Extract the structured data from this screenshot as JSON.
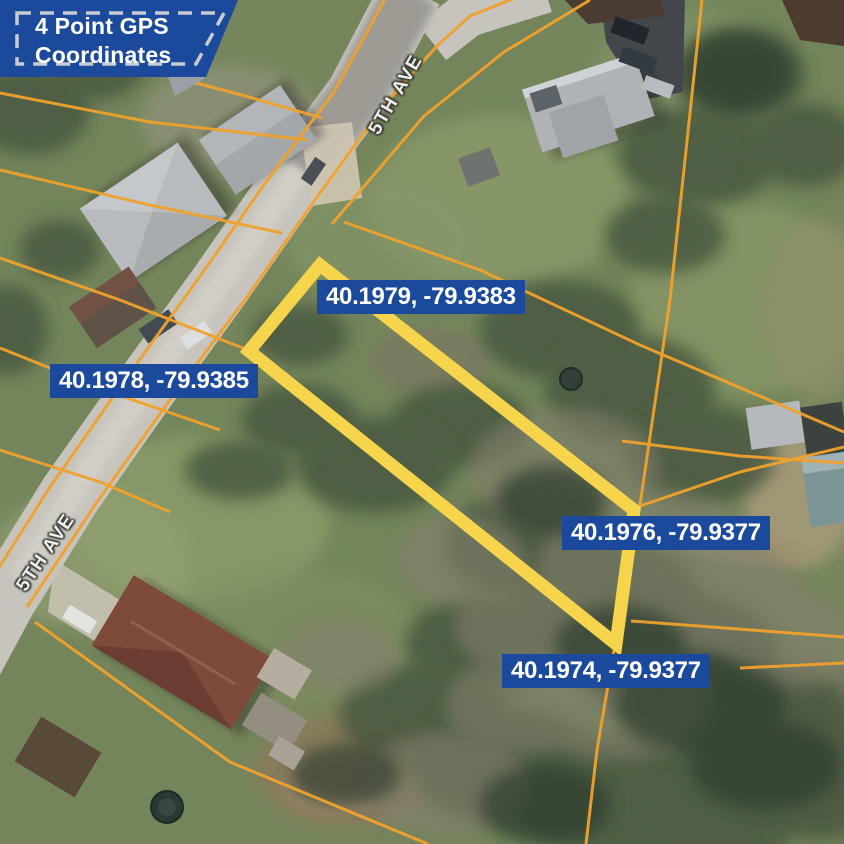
{
  "badge": {
    "line1": "4 Point GPS",
    "line2": "Coordinates"
  },
  "markers": [
    {
      "label": "40.1979, -79.9383"
    },
    {
      "label": "40.1978, -79.9385"
    },
    {
      "label": "40.1976, -79.9377"
    },
    {
      "label": "40.1974, -79.9377"
    }
  ],
  "streets": [
    {
      "name": "5TH AVE"
    },
    {
      "name": "5TH AVE"
    }
  ],
  "colors": {
    "label_bg": "#1b4a9c",
    "badge_bg": "#1b4a9c",
    "badge_dash": "#c7ccd2",
    "boundary_yellow": "#f6d44c",
    "parcel_line_orange": "#f0a22d",
    "pin_red": "#e8392b"
  }
}
